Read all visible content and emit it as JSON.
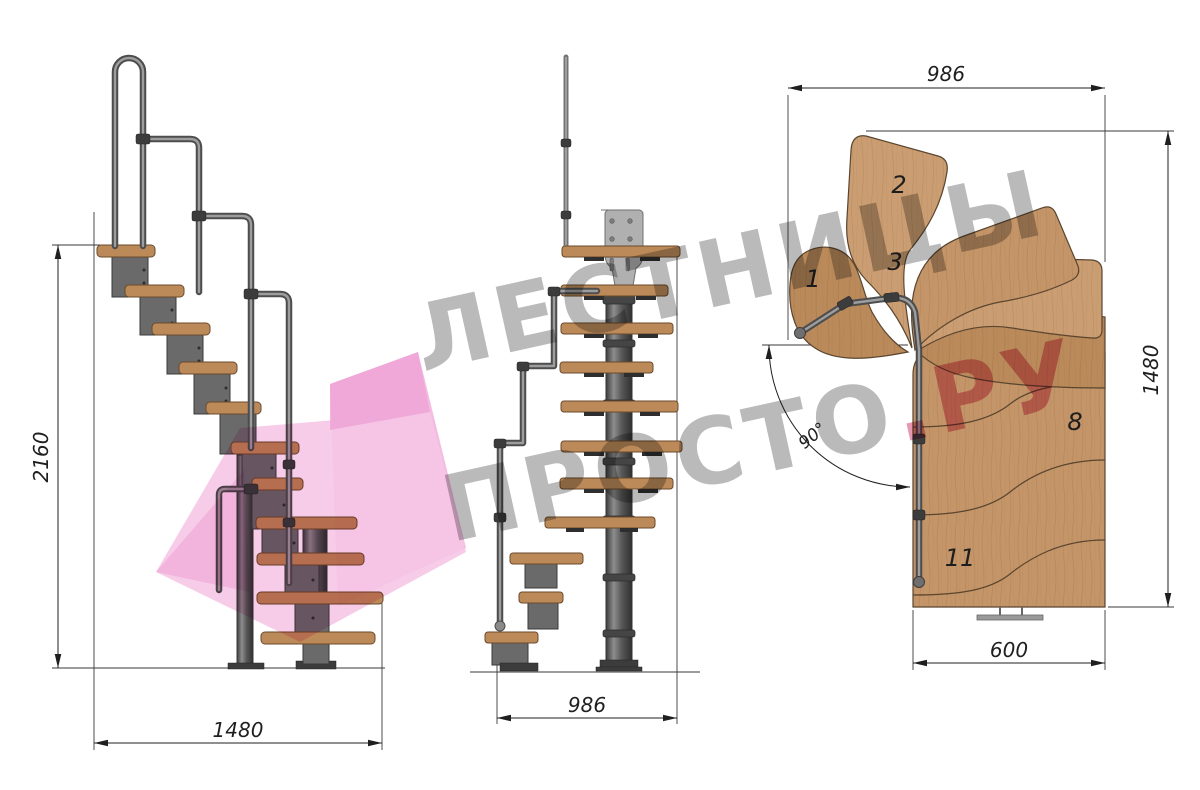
{
  "watermark": {
    "line1": "ЛЕСТНИЦЫ",
    "line2": "ПРОСТО",
    "suffix": ".РУ",
    "text_color": "#8c8c8c",
    "suffix_color": "#d4537c",
    "arrow_color": "#f3b5de"
  },
  "side_view": {
    "dims": {
      "height": "2160",
      "run": "1480"
    }
  },
  "front_view": {
    "dims": {
      "width": "986"
    }
  },
  "plan_view": {
    "dims": {
      "width": "986",
      "depth": "1480",
      "exit": "600",
      "angle": "90°"
    },
    "treads": {
      "n1": "1",
      "n2": "2",
      "n3": "3",
      "n8": "8",
      "n11": "11"
    }
  },
  "materials": {
    "wood": "#c49568",
    "metal": "#6a6a6a",
    "dimension_color": "#1f1f1f"
  }
}
